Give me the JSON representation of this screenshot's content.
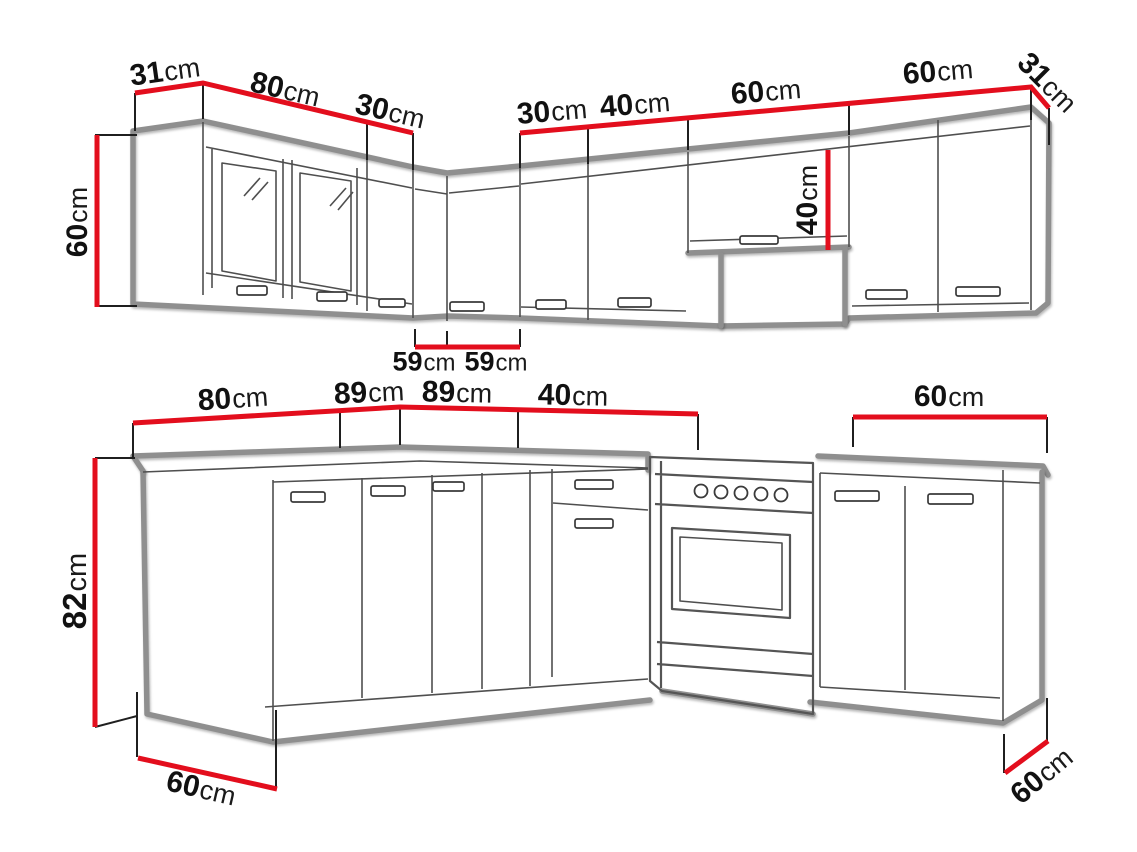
{
  "colors": {
    "dimension_red": "#e30e1d",
    "outline_gray": "#8f8f8f",
    "detail_line": "#4f4f4f",
    "text": "#111111",
    "background": "#ffffff"
  },
  "figure": {
    "type": "kitchen-set-dimension-diagram",
    "rows": [
      "wall-cabinets-row",
      "base-cabinets-row"
    ]
  },
  "labels": {
    "wall_left_depth": {
      "value": "31",
      "unit": "cm"
    },
    "wall_glass_width": {
      "value": "80",
      "unit": "cm"
    },
    "wall_door30_left": {
      "value": "30",
      "unit": "cm"
    },
    "wall_door30_right": {
      "value": "30",
      "unit": "cm"
    },
    "wall_door40_width": {
      "value": "40",
      "unit": "cm"
    },
    "wall_hood_width": {
      "value": "60",
      "unit": "cm"
    },
    "wall_double_width": {
      "value": "60",
      "unit": "cm"
    },
    "wall_right_depth": {
      "value": "31",
      "unit": "cm"
    },
    "wall_height": {
      "value": "60",
      "unit": "cm"
    },
    "hood_cabinet_height": {
      "value": "40",
      "unit": "cm"
    },
    "corner_depth_a": {
      "value": "59",
      "unit": "cm"
    },
    "corner_depth_b": {
      "value": "59",
      "unit": "cm"
    },
    "base_corner_width": {
      "value": "80",
      "unit": "cm"
    },
    "base_left_width": {
      "value": "89",
      "unit": "cm"
    },
    "base_right_width": {
      "value": "89",
      "unit": "cm"
    },
    "base_drawer_width": {
      "value": "40",
      "unit": "cm"
    },
    "base_double_width": {
      "value": "60",
      "unit": "cm"
    },
    "base_height": {
      "value": "82",
      "unit": "cm"
    },
    "base_left_depth": {
      "value": "60",
      "unit": "cm"
    },
    "base_right_depth": {
      "value": "60",
      "unit": "cm"
    }
  }
}
